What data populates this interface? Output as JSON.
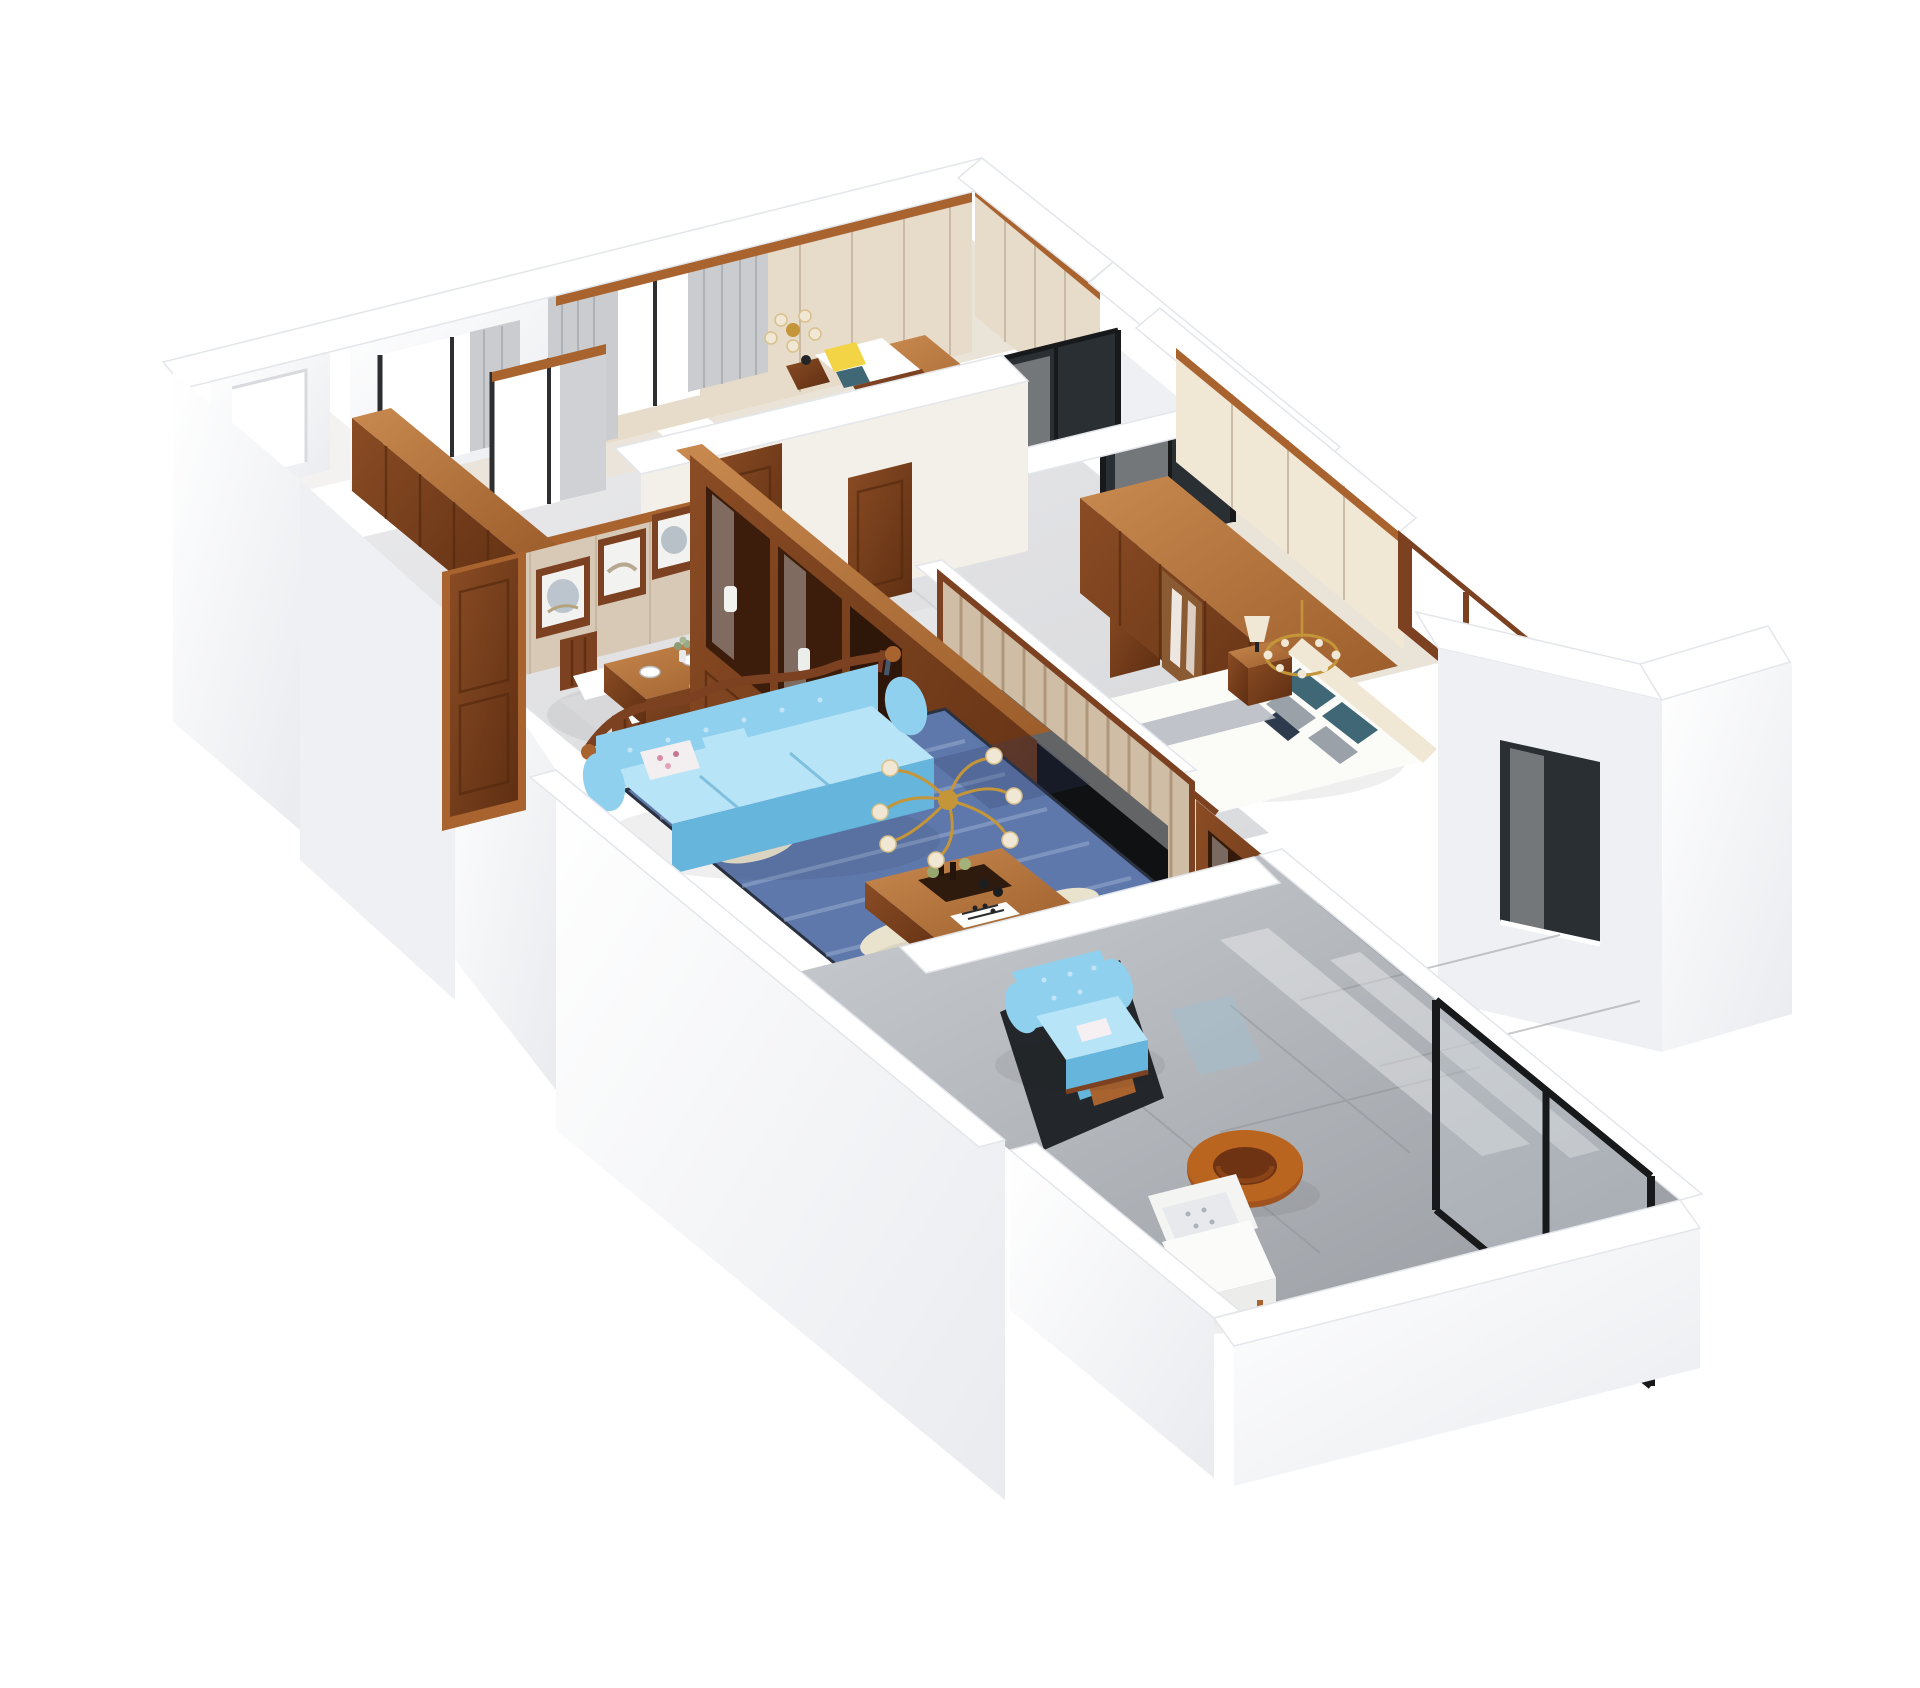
{
  "scene": {
    "title": "3D isometric cutaway floor-plan render of a furnished apartment, viewed from above on a white background",
    "type": "architectural dollhouse render",
    "background": "#ffffff",
    "rooms": [
      {
        "id": "second-bedroom",
        "label": "Second bedroom (top)",
        "contents": [
          "gray curtains on window wall",
          "gold chandelier with cream shades",
          "bed with yellow, white and teal pillows",
          "wood nightstand with small lamp",
          "wood console desk",
          "beige paneled walls with wood trim"
        ]
      },
      {
        "id": "kitchen",
        "label": "Kitchen (upper left)",
        "contents": [
          "window with dark frame and gray curtain",
          "row of wall-hung wood cabinets"
        ]
      },
      {
        "id": "utility-balcony",
        "label": "Utility balcony (far left)",
        "contents": [
          "bright window opening in white wall"
        ]
      },
      {
        "id": "dining-room",
        "label": "Dining room (center left)",
        "contents": [
          "beige wall with three framed landscape paintings",
          "wood dining table with white place settings and flower vase",
          "wood chairs with white cushions",
          "dark wood entry door"
        ]
      },
      {
        "id": "hallway",
        "label": "Hallway (center)",
        "contents": [
          "two paneled wood doors",
          "small framed artwork",
          "light tiled floor"
        ]
      },
      {
        "id": "bathrooms",
        "label": "Two bathrooms (top right)",
        "contents": [
          "dark glass partitions with black frames",
          "wood door"
        ]
      },
      {
        "id": "living-room",
        "label": "Living room (center)",
        "contents": [
          "light-blue tufted sofa with carved wood crest",
          "light-blue tufted armchair",
          "blue rug with cream leaf pattern",
          "wood coffee table with tray, bottles and chessboard",
          "gold chandelier with cream shades",
          "tall wood display cabinet with glass doors and white vases",
          "vertical-slat TV wall with black flat-screen TV",
          "long wood TV console",
          "wood wine cabinet with glass doors"
        ]
      },
      {
        "id": "master-bedroom",
        "label": "Master bedroom (right)",
        "contents": [
          "large wood wardrobe with paneled doors",
          "bed with white duvet, teal, gray and navy pillows",
          "cream paneled headboard wall",
          "wood nightstand with cream lamp",
          "gold chandelier",
          "wood-framed window"
        ]
      },
      {
        "id": "balcony",
        "label": "Balcony (bottom right)",
        "contents": [
          "glossy gray floor tiles",
          "black-framed glazing",
          "white cushioned armchair",
          "round wood ring stool"
        ]
      },
      {
        "id": "bay-volume",
        "label": "Exterior bay volume (far right)",
        "contents": [
          "white walls",
          "dark recessed window"
        ]
      }
    ]
  },
  "palette": {
    "wall_white": "#ffffff",
    "wall_edge": "#e3e6ea",
    "wall_shade": "#eef0f3",
    "wall_shade_deep": "#e0e3e7",
    "beige_wall": "#d8c8b6",
    "beige_panel": "#e7dcc9",
    "cream": "#f0e8d5",
    "wood": "#7c4120",
    "wood_dark": "#53280e",
    "wood_light": "#a9632f",
    "floor_line": "#c8c9cc",
    "warm_floor": "#eae3d7",
    "glass_dark": "#2a2f34",
    "frame_black": "#17191b",
    "sofa_blue": "#8fd0ee",
    "sofa_blue_deep": "#65b5dc",
    "sofa_blue_light": "#b8e4f7",
    "rug_blue": "#5e78ab",
    "rug_light": "#93a7cb",
    "rug_cream": "#e9e2cd",
    "tv_black": "#0f1113",
    "gold": "#c49539",
    "curtain": "#cacccf",
    "teal_pillow": "#3f6776",
    "yellow_pillow": "#f3d444",
    "gray_pillow": "#9aa1a9"
  }
}
